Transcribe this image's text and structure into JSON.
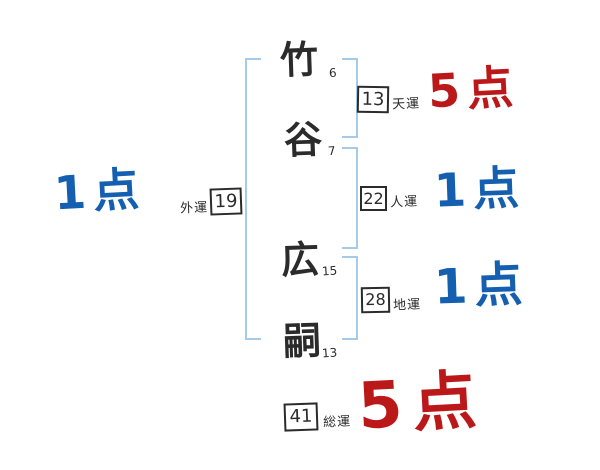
{
  "diagram": {
    "kind": "name-fortune-stroke-diagram",
    "name_column": {
      "chars": [
        {
          "char": "竹",
          "strokes": "6"
        },
        {
          "char": "谷",
          "strokes": "7"
        },
        {
          "char": "広",
          "strokes": "15"
        },
        {
          "char": "嗣",
          "strokes": "13"
        }
      ]
    },
    "fortunes": [
      {
        "id": "tenun",
        "label": "天運",
        "value": "13",
        "score": "5点",
        "score_color": "#bb1919"
      },
      {
        "id": "jinun",
        "label": "人運",
        "value": "22",
        "score": "1点",
        "score_color": "#155fb0"
      },
      {
        "id": "chiun",
        "label": "地運",
        "value": "28",
        "score": "1点",
        "score_color": "#155fb0"
      },
      {
        "id": "gaiun",
        "label": "外運",
        "value": "19",
        "score": "1点",
        "score_color": "#155fb0"
      },
      {
        "id": "souun",
        "label": "総運",
        "value": "41",
        "score": "5点",
        "score_color": "#bb1919"
      }
    ],
    "colors": {
      "score_high_red": "#bb1919",
      "score_low_blue": "#155fb0",
      "bracket_blue": "#a5cbe8",
      "ink": "#2b2b2b",
      "background": "#ffffff"
    }
  }
}
